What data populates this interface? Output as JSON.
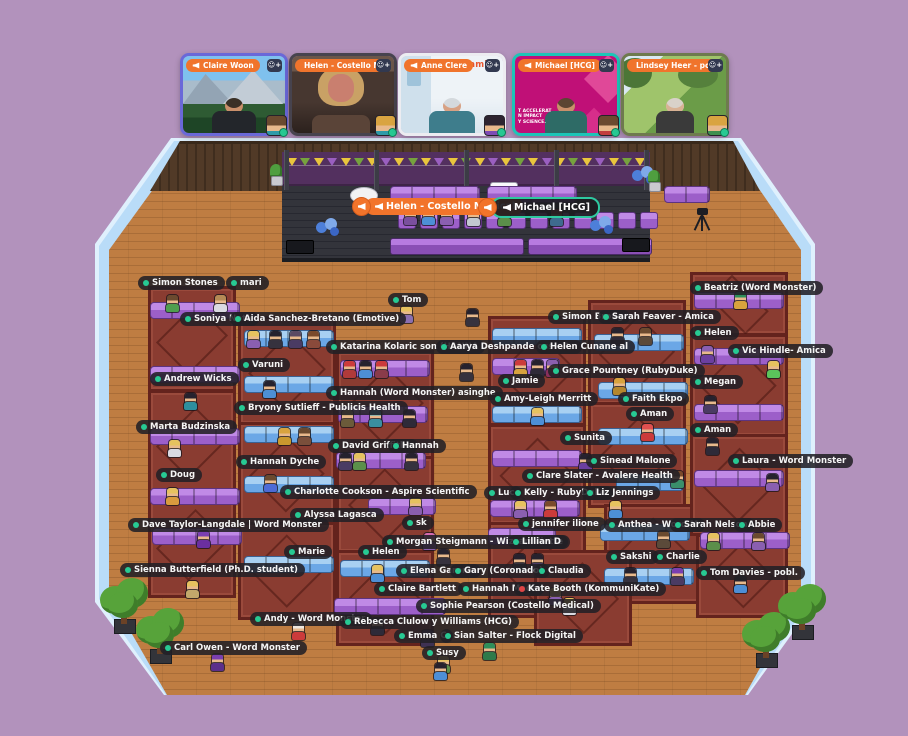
{
  "app": {
    "name": "virtual-event-space",
    "background_color": "#b292bc"
  },
  "video_bar": {
    "tiles": [
      {
        "name": "Claire Woon",
        "frame": "#6a68d8",
        "scene": "mountains",
        "speaking": false,
        "mini_hair": "#6b4a2f",
        "mini_shirt": "#2e9aa8"
      },
      {
        "name": "Helen - Costello Me",
        "frame": "#47434e",
        "scene": "indoor-dark",
        "speaking": false,
        "mini_hair": "#d9a441",
        "mini_shirt": "#2e9aa8"
      },
      {
        "name": "Anne Clere",
        "frame": "#ececf1",
        "scene": "bright-office",
        "badge": "amica",
        "speaking": false,
        "mini_hair": "#2d2430",
        "mini_shirt": "#7d4bb5"
      },
      {
        "name": "Michael [HCG]",
        "frame": "#1cc5b7",
        "scene": "magenta-brand",
        "caption_lines": [
          "T ACCELERAT",
          "N IMPACT",
          "Y SCIENCE."
        ],
        "speaking": true,
        "mini_hair": "#6b4a2f",
        "mini_shirt": "#c23e3e"
      },
      {
        "name": "Lindsey Heer - pobl.",
        "frame": "#6e7a4e",
        "scene": "outdoor-festival",
        "speaking": false,
        "mini_hair": "#d9a441",
        "mini_shirt": "#3f8f4f"
      }
    ],
    "xs": [
      180,
      289,
      398,
      512,
      621
    ]
  },
  "stage": {
    "speaker_labels": [
      {
        "text": "Helen - Costello Medical",
        "style": "orange",
        "x": 352
      },
      {
        "text": "Michael [HCG]",
        "style": "greenline",
        "x": 478
      }
    ]
  },
  "colors": {
    "green_status": "#27c993",
    "red_status": "#e04545",
    "label_bg": "rgba(34,32,38,.88)",
    "floor": "#bf7d42",
    "wall": "#b9dcf8",
    "rug": "#8a3c31",
    "couch_purple": "#9c5fc9",
    "couch_blue": "#6ba7e6"
  },
  "scene": {
    "labels": [
      [
        138,
        276,
        "Simon Stones"
      ],
      [
        226,
        276,
        "mari"
      ],
      [
        180,
        312,
        "Soniya Nota"
      ],
      [
        230,
        312,
        "Aida Sanchez-Bretano (Emotive)"
      ],
      [
        150,
        372,
        "Andrew Wicks"
      ],
      [
        136,
        420,
        "Marta Budzinska"
      ],
      [
        156,
        468,
        "Doug"
      ],
      [
        128,
        518,
        "Dave Taylor-Langdale | Word Monster"
      ],
      [
        120,
        563,
        "Sienna Butterfield (Ph.D. student)"
      ],
      [
        160,
        641,
        "Carl Owen - Word Monster"
      ],
      [
        238,
        358,
        "Varuni"
      ],
      [
        234,
        401,
        "Bryony Sutlieff - Publicis Health"
      ],
      [
        236,
        455,
        "Hannah Dyche"
      ],
      [
        280,
        485,
        "Charlotte Cookson - Aspire Scientific"
      ],
      [
        290,
        508,
        "Alyssa Lagasca"
      ],
      [
        284,
        545,
        "Marie"
      ],
      [
        250,
        612,
        "Andy - Word Monster"
      ],
      [
        388,
        293,
        "Tom"
      ],
      [
        326,
        340,
        "Katarina Kolaric son (HANNA"
      ],
      [
        436,
        340,
        "Aarya Deshpande oss - Re"
      ],
      [
        536,
        340,
        "Helen Cunane al"
      ],
      [
        326,
        386,
        "Hannah (Word Monster) asinghe"
      ],
      [
        328,
        439,
        "David Griffiths"
      ],
      [
        388,
        439,
        "Hannah"
      ],
      [
        402,
        516,
        "sk"
      ],
      [
        382,
        535,
        "Morgan Steigmann - Wizzard liette"
      ],
      [
        508,
        535,
        "Lillian D"
      ],
      [
        358,
        545,
        "Helen"
      ],
      [
        396,
        564,
        "Elena Garonn"
      ],
      [
        450,
        564,
        "Gary (Coronado)"
      ],
      [
        534,
        564,
        "Claudia"
      ],
      [
        374,
        582,
        "Claire Bartlett"
      ],
      [
        458,
        582,
        "Hannah Mace"
      ],
      [
        514,
        582,
        "Kate Booth (KommuniKate)",
        "red"
      ],
      [
        416,
        599,
        "Sophie Pearson (Costello Medical)"
      ],
      [
        340,
        615,
        "Rebecca Clulow y Williams (HCG)"
      ],
      [
        394,
        629,
        "Emma C"
      ],
      [
        440,
        629,
        "Sian Salter - Flock Digital"
      ],
      [
        422,
        646,
        "Susy"
      ],
      [
        548,
        310,
        "Simon Broug"
      ],
      [
        598,
        310,
        "Sarah Feaver - Amica"
      ],
      [
        548,
        364,
        "Grace Pountney (RubyDuke)"
      ],
      [
        498,
        374,
        "Jamie"
      ],
      [
        490,
        392,
        "Amy-Leigh Merritt"
      ],
      [
        618,
        392,
        "Faith Ekpo"
      ],
      [
        626,
        407,
        "Aman"
      ],
      [
        560,
        431,
        "Sunita"
      ],
      [
        690,
        423,
        "Aman"
      ],
      [
        586,
        454,
        "Sinead Malone"
      ],
      [
        522,
        469,
        "Clare Slater - Avalere Health"
      ],
      [
        484,
        486,
        "Luc"
      ],
      [
        510,
        486,
        "Kelly - RubyDuke"
      ],
      [
        582,
        486,
        "Liz Jennings"
      ],
      [
        518,
        517,
        "jennifer ilione"
      ],
      [
        604,
        518,
        "Anthea - Word M"
      ],
      [
        670,
        518,
        "Sarah Nelson"
      ],
      [
        734,
        518,
        "Abbie"
      ],
      [
        606,
        550,
        "Sakshi"
      ],
      [
        652,
        550,
        "Charlie"
      ],
      [
        696,
        566,
        "Tom Davies - pobl."
      ],
      [
        690,
        281,
        "Beatriz (Word Monster)"
      ],
      [
        690,
        326,
        "Helen"
      ],
      [
        728,
        344,
        "Vic Hindle- Amica"
      ],
      [
        690,
        375,
        "Megan"
      ],
      [
        728,
        454,
        "Laura - Word Monster"
      ]
    ],
    "blocks": [
      [
        148,
        286,
        82,
        100
      ],
      [
        148,
        390,
        82,
        100
      ],
      [
        148,
        492,
        82,
        100
      ],
      [
        238,
        316,
        92,
        104
      ],
      [
        238,
        422,
        92,
        98
      ],
      [
        238,
        522,
        92,
        92
      ],
      [
        336,
        350,
        92,
        104
      ],
      [
        336,
        456,
        92,
        92
      ],
      [
        336,
        550,
        92,
        90
      ],
      [
        488,
        316,
        92,
        104
      ],
      [
        488,
        424,
        92,
        96
      ],
      [
        488,
        522,
        92,
        90
      ],
      [
        588,
        300,
        92,
        100
      ],
      [
        588,
        402,
        92,
        100
      ],
      [
        604,
        504,
        92,
        94
      ],
      [
        690,
        272,
        92,
        58
      ],
      [
        690,
        334,
        92,
        98
      ],
      [
        690,
        434,
        92,
        96
      ],
      [
        696,
        534,
        86,
        78
      ],
      [
        534,
        550,
        92,
        90
      ]
    ],
    "couches": [
      [
        150,
        302,
        4,
        "p"
      ],
      [
        150,
        366,
        4,
        "p"
      ],
      [
        150,
        428,
        4,
        "p"
      ],
      [
        150,
        488,
        4,
        "p"
      ],
      [
        152,
        528,
        4,
        "p"
      ],
      [
        244,
        330,
        4,
        "b"
      ],
      [
        244,
        376,
        4,
        "b"
      ],
      [
        244,
        426,
        4,
        "b"
      ],
      [
        244,
        476,
        4,
        "b"
      ],
      [
        244,
        556,
        4,
        "b"
      ],
      [
        340,
        360,
        4,
        "p"
      ],
      [
        338,
        406,
        4,
        "p"
      ],
      [
        336,
        452,
        4,
        "p"
      ],
      [
        368,
        498,
        3,
        "p"
      ],
      [
        340,
        560,
        4,
        "b"
      ],
      [
        334,
        598,
        5,
        "p"
      ],
      [
        492,
        328,
        4,
        "b"
      ],
      [
        492,
        358,
        3,
        "p"
      ],
      [
        492,
        406,
        4,
        "b"
      ],
      [
        492,
        450,
        4,
        "p"
      ],
      [
        490,
        500,
        4,
        "p"
      ],
      [
        488,
        528,
        3,
        "p"
      ],
      [
        594,
        334,
        4,
        "b"
      ],
      [
        598,
        382,
        4,
        "b"
      ],
      [
        598,
        428,
        4,
        "b"
      ],
      [
        616,
        474,
        3,
        "b"
      ],
      [
        600,
        524,
        4,
        "b"
      ],
      [
        604,
        568,
        4,
        "b"
      ],
      [
        694,
        292,
        4,
        "p"
      ],
      [
        694,
        348,
        4,
        "p"
      ],
      [
        694,
        404,
        4,
        "p"
      ],
      [
        694,
        470,
        4,
        "p"
      ],
      [
        700,
        532,
        4,
        "p"
      ],
      [
        390,
        186,
        4,
        "p"
      ],
      [
        487,
        186,
        4,
        "p"
      ],
      [
        664,
        186,
        2,
        "p"
      ]
    ],
    "chairs": [
      [
        398,
        212
      ],
      [
        420,
        212
      ],
      [
        442,
        212
      ],
      [
        464,
        212
      ],
      [
        486,
        212
      ],
      [
        508,
        212
      ],
      [
        530,
        212
      ],
      [
        552,
        212
      ],
      [
        574,
        212
      ],
      [
        596,
        212
      ],
      [
        618,
        212
      ],
      [
        640,
        212
      ]
    ],
    "desks": [
      [
        390,
        238,
        132,
        15
      ],
      [
        528,
        238,
        122,
        15
      ]
    ],
    "speaker_boxes": [
      [
        286,
        240,
        26,
        12
      ],
      [
        622,
        238,
        26,
        12
      ]
    ],
    "white_tables": [
      [
        350,
        187,
        26,
        15
      ],
      [
        534,
        188,
        20,
        13
      ]
    ],
    "sign_boards": [
      [
        490,
        182,
        26,
        17
      ]
    ],
    "avatars": [
      [
        403,
        208,
        "#3a2c34",
        "#7a4f9e"
      ],
      [
        421,
        208,
        "#e6c25f",
        "#4d8fd6"
      ],
      [
        439,
        208,
        "#7a4a2b",
        "#8a5fb0"
      ],
      [
        466,
        209,
        "#3f6b3a",
        "#c2c8d0"
      ],
      [
        497,
        209,
        "#e6c25f",
        "#5b8f4a"
      ],
      [
        549,
        209,
        "#cc3b3b",
        "#3e6b8f"
      ],
      [
        399,
        306,
        "#e6c25f",
        "#8a6fb0"
      ],
      [
        465,
        309,
        "#26222e",
        "#36323e"
      ],
      [
        459,
        364,
        "#26222e",
        "#36323e"
      ],
      [
        165,
        295,
        "#6b4a2f",
        "#4f9e4f"
      ],
      [
        213,
        295,
        "#b58a55",
        "#dadae2"
      ],
      [
        183,
        393,
        "#26222e",
        "#2e8f9e"
      ],
      [
        167,
        440,
        "#e6c25f",
        "#dadae2"
      ],
      [
        165,
        488,
        "#e6c25f",
        "#d89a3e"
      ],
      [
        196,
        531,
        "#7a3fb0",
        "#6b2fa0"
      ],
      [
        185,
        581,
        "#e6c25f",
        "#c2a86b"
      ],
      [
        210,
        654,
        "#7a3fb0",
        "#5b2f8a"
      ],
      [
        246,
        331,
        "#e6c25f",
        "#8a5fb0"
      ],
      [
        268,
        331,
        "#26222e",
        "#36323e"
      ],
      [
        288,
        331,
        "#5b4a63",
        "#4a3b63"
      ],
      [
        306,
        331,
        "#7a4a2b",
        "#8a4a3b"
      ],
      [
        262,
        381,
        "#26222e",
        "#4d8fd6"
      ],
      [
        277,
        428,
        "#d8a33e",
        "#c9982e"
      ],
      [
        297,
        428,
        "#6b4a2f",
        "#7a4f3b"
      ],
      [
        263,
        475,
        "#6b4a2f",
        "#4d6bd6"
      ],
      [
        291,
        623,
        "#efe8e0",
        "#cc3b3b"
      ],
      [
        342,
        361,
        "#cc3b3b",
        "#b03a3a"
      ],
      [
        358,
        361,
        "#26222e",
        "#4d8fd6"
      ],
      [
        374,
        361,
        "#cc3b3b",
        "#8a3b4a"
      ],
      [
        340,
        410,
        "#b5a06b",
        "#6b5b3a"
      ],
      [
        368,
        410,
        "#3ab5c9",
        "#3a8fa0"
      ],
      [
        402,
        410,
        "#26222e",
        "#2e2a38"
      ],
      [
        338,
        453,
        "#26222e",
        "#4a3b63"
      ],
      [
        352,
        453,
        "#e6c25f",
        "#5b8f4a"
      ],
      [
        404,
        453,
        "#26222e",
        "#36323e"
      ],
      [
        408,
        498,
        "#e6c25f",
        "#8a5fb0"
      ],
      [
        422,
        533,
        "#d66bb0",
        "#8a5fb0"
      ],
      [
        436,
        549,
        "#26222e",
        "#36323e"
      ],
      [
        370,
        565,
        "#e6c25f",
        "#4d8fd6"
      ],
      [
        370,
        618,
        "#26222e",
        "#2e2a38"
      ],
      [
        420,
        630,
        "#4a3b63",
        "#3e3253"
      ],
      [
        436,
        656,
        "#e6c25f",
        "#5b8f4a"
      ],
      [
        482,
        643,
        "#2e8f5b",
        "#2e7a4a"
      ],
      [
        562,
        598,
        "#e6c25f",
        "#dadae2"
      ],
      [
        513,
        360,
        "#cc3b3b",
        "#d8a33e"
      ],
      [
        530,
        360,
        "#26222e",
        "#2e2a38"
      ],
      [
        545,
        360,
        "#8a5fb0",
        "#8a2f5b"
      ],
      [
        530,
        408,
        "#e6c25f",
        "#4d8fd6"
      ],
      [
        578,
        454,
        "#26222e",
        "#6b3fa0"
      ],
      [
        513,
        501,
        "#e6c25f",
        "#8a5fb0"
      ],
      [
        543,
        501,
        "#7a4a2b",
        "#cc3b3b"
      ],
      [
        608,
        501,
        "#e6c25f",
        "#4d8fd6"
      ],
      [
        512,
        554,
        "#26222e",
        "#36323e"
      ],
      [
        530,
        554,
        "#26222e",
        "#4a3b63"
      ],
      [
        548,
        588,
        "#e6c25f",
        "#8a5fb0"
      ],
      [
        610,
        328,
        "#26222e",
        "#2e2a38"
      ],
      [
        638,
        328,
        "#6b4a2f",
        "#5b4a3a"
      ],
      [
        612,
        378,
        "#d8a33e",
        "#b5872e"
      ],
      [
        640,
        424,
        "#e05050",
        "#cc3b3b"
      ],
      [
        670,
        471,
        "#7a4a2b",
        "#3a8f6b"
      ],
      [
        656,
        531,
        "#6b4a2f",
        "#5b4a3a"
      ],
      [
        623,
        568,
        "#26222e",
        "#36323e"
      ],
      [
        670,
        568,
        "#7a3fb0",
        "#4a3b63"
      ],
      [
        733,
        292,
        "#2e8f5b",
        "#d8a33e"
      ],
      [
        700,
        346,
        "#8a5fb0",
        "#6b3fa0"
      ],
      [
        766,
        361,
        "#e6c25f",
        "#5bc45b"
      ],
      [
        703,
        396,
        "#26222e",
        "#4a3b63"
      ],
      [
        705,
        438,
        "#26222e",
        "#2e2a38"
      ],
      [
        765,
        474,
        "#26222e",
        "#8a5fb0"
      ],
      [
        706,
        533,
        "#e6c25f",
        "#5b8f4a"
      ],
      [
        751,
        533,
        "#6b4a2f",
        "#8a5fb0"
      ],
      [
        733,
        576,
        "#26222e",
        "#4d8fd6"
      ],
      [
        433,
        663,
        "#26222e",
        "#4d8fd6"
      ]
    ],
    "trees": [
      [
        98,
        574
      ],
      [
        134,
        604
      ],
      [
        740,
        608
      ],
      [
        776,
        580
      ]
    ],
    "balloons": [
      [
        316,
        218
      ],
      [
        590,
        216
      ],
      [
        632,
        166
      ]
    ],
    "plants": [
      [
        268,
        164
      ],
      [
        646,
        170
      ]
    ],
    "flags": {
      "x": 287,
      "y": 158,
      "count": 27,
      "step": 13.4,
      "colors": [
        "#e9c53d",
        "#76a23e",
        "#e9c53d",
        "#9a5fc0"
      ]
    }
  }
}
